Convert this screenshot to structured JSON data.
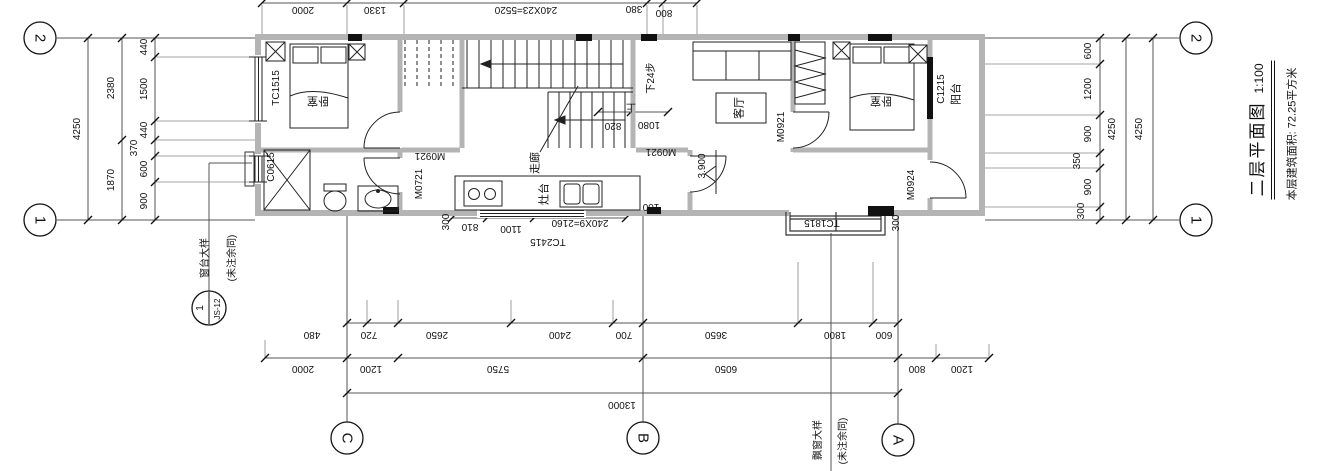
{
  "title_block": {
    "title": "二层平面图",
    "scale": "1:100",
    "area_note": "本层建筑面积: 72.25平方米"
  },
  "grid": {
    "axis_2": "2",
    "axis_1": "1",
    "axis_c": "C",
    "axis_b": "B",
    "axis_a": "A"
  },
  "dims": {
    "left_outer": "4250",
    "left_mid": [
      "2380",
      "1870"
    ],
    "left_inner": [
      "440",
      "1500",
      "440",
      "370",
      "600",
      "900"
    ],
    "right_inner": [
      "600",
      "1200",
      "900",
      "350",
      "900",
      "300"
    ],
    "right_mid": "4250",
    "right_outer": "4250",
    "top": [
      "2000",
      "1330",
      "240X23=5520",
      "380",
      "800"
    ],
    "bottom_row1": [
      "480",
      "720",
      "2650",
      "2400",
      "700",
      "3650",
      "1800",
      "600"
    ],
    "bottom_row2": [
      "2000",
      "1200",
      "5750",
      "6050",
      "800",
      "1200"
    ],
    "bottom_total": "13000",
    "stair": [
      "820",
      "1080"
    ],
    "kitchen": [
      "300",
      "810",
      "1100",
      "240X9=2160",
      "100"
    ],
    "balcony_side": "300"
  },
  "rooms": {
    "bedroom": "卧室",
    "living_room": "客厅",
    "corridor": "走廊",
    "balcony": "阳台",
    "stove_counter": "灶台"
  },
  "openings": {
    "tc1515": "TC1515",
    "c0615": "C0615",
    "tc2415": "TC2415",
    "tc1815": "TC1815",
    "c1215": "C1215",
    "m0721": "M0721",
    "m0921": "M0921",
    "m0924": "M0924"
  },
  "stairs": {
    "down_note": "下24步",
    "up_note": "上"
  },
  "level_mark": "3.900",
  "callouts": {
    "sill": {
      "name": "窗台大样",
      "note": "(未注余同)",
      "detail_no": "1",
      "sheet_no": "JS-12"
    },
    "bay": {
      "name": "飘窗大样",
      "note": "(未注余同)"
    }
  }
}
